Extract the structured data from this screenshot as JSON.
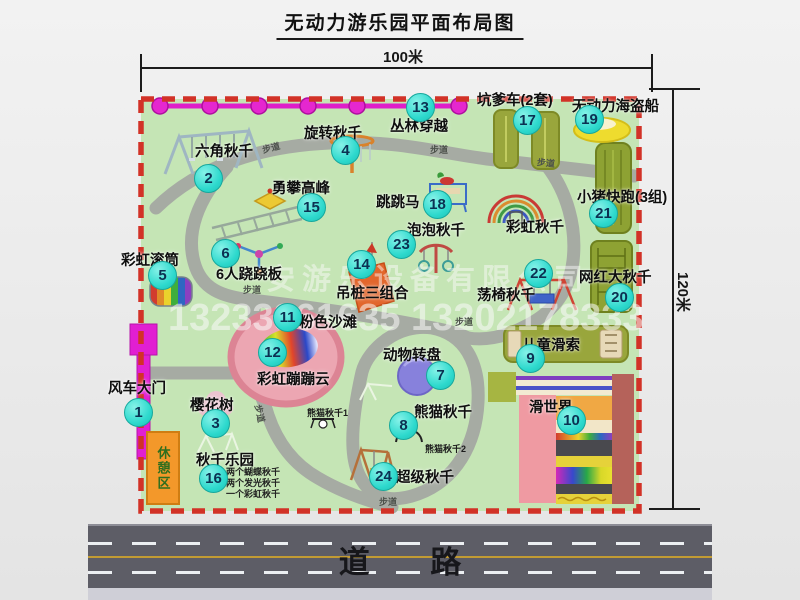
{
  "title": "无动力游乐园平面布局图",
  "dims": {
    "top": "100米",
    "right": "120米"
  },
  "watermark": {
    "company": "安游乐设备有限公司",
    "phone": "13233861635 13202178333"
  },
  "labels": {
    "trail": "步道",
    "road": "道 路",
    "rest_area": "休憩区",
    "rainbow_swing": "彩虹秋千",
    "panda_swing_1": "熊猫秋千1",
    "panda_swing_2": "熊猫秋千2"
  },
  "swing_park_notes": [
    "两个蝴蝶秋千",
    "两个发光秋千",
    "一个彩虹秋千"
  ],
  "features": [
    {
      "num": "1",
      "label": "风车大门"
    },
    {
      "num": "2",
      "label": "六角秋千"
    },
    {
      "num": "3",
      "label": "樱花树"
    },
    {
      "num": "4",
      "label": "旋转秋千"
    },
    {
      "num": "5",
      "label": "彩虹滚筒"
    },
    {
      "num": "6",
      "label": "6人跷跷板"
    },
    {
      "num": "7",
      "label": "动物转盘"
    },
    {
      "num": "8",
      "label": "熊猫秋千"
    },
    {
      "num": "9",
      "label": "儿童滑索"
    },
    {
      "num": "10",
      "label": "滑世界"
    },
    {
      "num": "11",
      "label": "粉色沙滩"
    },
    {
      "num": "12",
      "label": "彩虹蹦蹦云"
    },
    {
      "num": "13",
      "label": "丛林穿越"
    },
    {
      "num": "14",
      "label": "吊桩三组合"
    },
    {
      "num": "15",
      "label": "勇攀高峰"
    },
    {
      "num": "16",
      "label": "秋千乐园"
    },
    {
      "num": "17",
      "label": "坑爹车(2套)"
    },
    {
      "num": "18",
      "label": "跳跳马"
    },
    {
      "num": "19",
      "label": "无动力海盗船"
    },
    {
      "num": "20",
      "label": "网红大秋千"
    },
    {
      "num": "21",
      "label": "小猪快跑(3组)"
    },
    {
      "num": "22",
      "label": "荡椅秋千"
    },
    {
      "num": "23",
      "label": "泡泡秋千"
    },
    {
      "num": "24",
      "label": "超级秋千"
    }
  ],
  "colors": {
    "map_green": "#c5e5b5",
    "border_red": "#d23227",
    "path_gray": "#a6aba3",
    "zipline_magenta": "#e11fd2",
    "marker_teal": "#2dd9cd",
    "olive_equipment": "#99a63c",
    "beach_pink": "#eca6b2",
    "gate_magenta": "#e11fd2",
    "rest_orange": "#f3982a"
  }
}
